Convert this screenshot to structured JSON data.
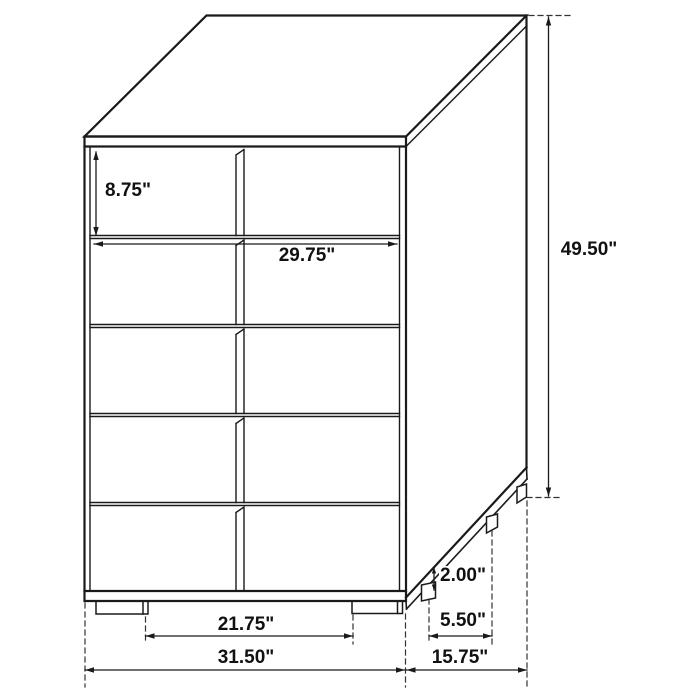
{
  "dimensions": {
    "drawer_height": "8.75\"",
    "drawer_width": "29.75\"",
    "overall_height": "49.50\"",
    "leg_height": "2.00\"",
    "side_leg_spacing": "5.50\"",
    "front_leg_spacing": "21.75\"",
    "overall_width": "31.50\"",
    "overall_depth": "15.75\""
  },
  "colors": {
    "line": "#1a1a1a",
    "background": "#ffffff",
    "label_text": "#111111"
  }
}
